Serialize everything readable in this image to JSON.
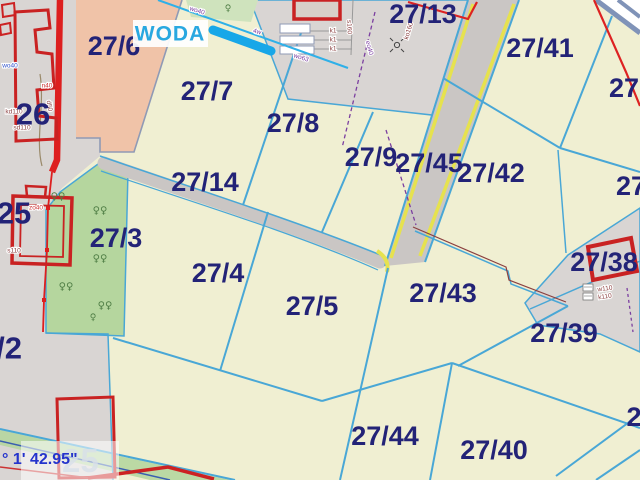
{
  "map": {
    "type": "cadastral-parcel-map",
    "woda_label": "WODA",
    "coordinate_readout": "° 1' 42.95\"",
    "watermark": "25",
    "symbols": {
      "tree_pair": "♀♀",
      "tree": "♀"
    },
    "colors": {
      "parcel_fill": "#f0efd2",
      "urban_fill": "#d9d5d3",
      "forest_fill": "#b5d69e",
      "orchard_fill": "#f0c3a8",
      "boundary_cyan": "#49a7d6",
      "label_navy": "#232377",
      "building_red": "#c92222",
      "road_gray": "#cac6c4",
      "road_yellow": "#e6e24e",
      "water_cyan": "#18a7e8",
      "woda_text": "#29a8e0",
      "coord_text": "#2433cc"
    },
    "parcels": [
      {
        "label": "27/6"
      },
      {
        "label": "27/7"
      },
      {
        "label": "27/8"
      },
      {
        "label": "27/13"
      },
      {
        "label": "27/41"
      },
      {
        "label": "27/9"
      },
      {
        "label": "27/45"
      },
      {
        "label": "27/42"
      },
      {
        "label": "27/14"
      },
      {
        "label": "27/3"
      },
      {
        "label": "27/4"
      },
      {
        "label": "27/5"
      },
      {
        "label": "27/43"
      },
      {
        "label": "27/38"
      },
      {
        "label": "27/39"
      },
      {
        "label": "27/44"
      },
      {
        "label": "27/40"
      },
      {
        "label": "26"
      },
      {
        "label": "25"
      },
      {
        "label": "/2"
      },
      {
        "label": "27"
      },
      {
        "label": "27"
      },
      {
        "label": "2"
      }
    ],
    "annotations": [
      {
        "text": "wo40"
      },
      {
        "text": "wo63"
      },
      {
        "text": "4w"
      },
      {
        "text": "eo40"
      },
      {
        "text": "ko160"
      },
      {
        "text": "s160"
      },
      {
        "text": "k1"
      },
      {
        "text": "k1"
      },
      {
        "text": "k1"
      },
      {
        "text": "w110"
      },
      {
        "text": "k110"
      },
      {
        "text": "n40"
      },
      {
        "text": "wo40"
      },
      {
        "text": "kd110"
      },
      {
        "text": "sd110"
      },
      {
        "text": "d50"
      },
      {
        "text": "zo40"
      },
      {
        "text": "s110"
      }
    ]
  }
}
